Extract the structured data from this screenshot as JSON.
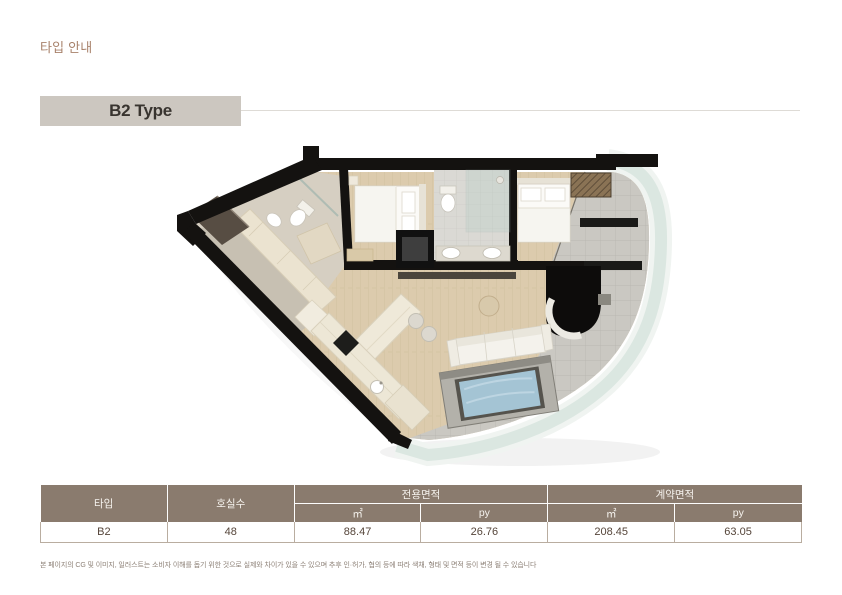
{
  "page": {
    "section_title": "타입 안내",
    "footnote": "본 페이지의 CG 및 이미지, 일러스트는 소비자 이해를 돕기 위한 것으로 실제와 차이가 있을 수 있으며 추후 인·허가, 협의 등에 따라 색채, 형태 및 면적 등이 변경 될 수 있습니다"
  },
  "type_section": {
    "title": "B2 Type"
  },
  "table": {
    "headers": {
      "type": "타입",
      "rooms": "호실수",
      "exclusive_area": "전용면적",
      "contract_area": "계약면적",
      "m2": "㎡",
      "py": "py"
    },
    "row": {
      "type": "B2",
      "rooms": "48",
      "exclusive_m2": "88.47",
      "exclusive_py": "26.76",
      "contract_m2": "208.45",
      "contract_py": "63.05"
    }
  },
  "colors": {
    "accent_brown": "#a8826b",
    "title_box_bg": "#ccc7c0",
    "table_header_bg": "#8a7b6e",
    "table_border": "#b9ada0",
    "wall_black": "#141210",
    "wood_floor": "#dccbad",
    "terrace_tile": "#cac8c2",
    "curtain_wall_glass": "#dbe7e1",
    "tub_water": "#a4c4d4"
  }
}
